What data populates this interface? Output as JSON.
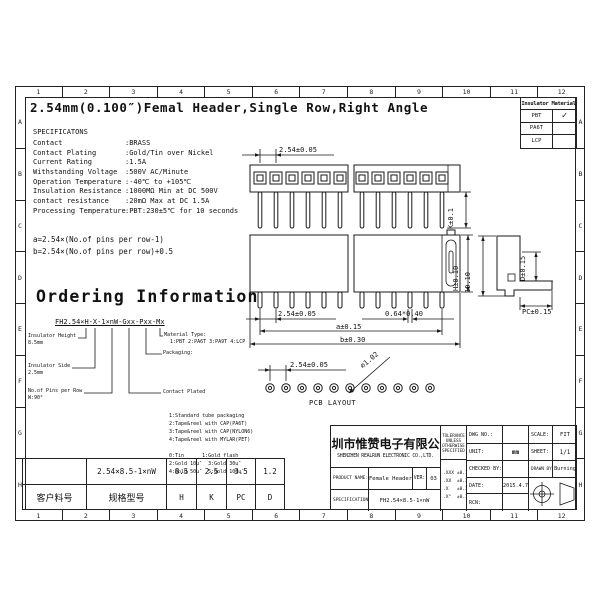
{
  "page": {
    "title": "2.54mm(0.100″)Femal Header,Single Row,Right Angle"
  },
  "border": {
    "columns": [
      "1",
      "2",
      "3",
      "4",
      "5",
      "6",
      "7",
      "8",
      "9",
      "10",
      "11",
      "12"
    ],
    "rows": [
      "A",
      "B",
      "C",
      "D",
      "E",
      "F",
      "G",
      "H"
    ]
  },
  "insulator_table": {
    "header": "Insulator Material",
    "rows": [
      {
        "name": "PBT",
        "check": "✓"
      },
      {
        "name": "PA6T",
        "check": ""
      },
      {
        "name": "LCP",
        "check": ""
      }
    ]
  },
  "specs": {
    "heading": "SPECIFICATONS",
    "rows": [
      {
        "label": "Contact",
        "value": ":BRASS"
      },
      {
        "label": "Contact Plating",
        "value": ":Gold/Tin over Nickel"
      },
      {
        "label": "Current Rating",
        "value": ":1.5A"
      },
      {
        "label": "Withstanding Voltage",
        "value": ":500V AC/Minute"
      },
      {
        "label": "Operation Temperature",
        "value": ":-40℃ to +105℃"
      },
      {
        "label": "Insulation Resistance",
        "value": ":1000MΩ Min at DC 500V"
      },
      {
        "label": "contact resistance",
        "value": ":20mΩ Max at DC 1.5A"
      },
      {
        "label": "Processing Temperature",
        "value": ":PBT:230±5℃ for 10 seconds"
      }
    ]
  },
  "notes": {
    "a": "a=2.54×(No.of pins per row-1)",
    "b": "b=2.54×(No.of pins per row)+0.5"
  },
  "ordering": {
    "heading": "Ordering Information",
    "code": "FH2.54×H-X-1×nW-Gxx-Pxx-Mx",
    "height": {
      "label": "Insulator Height",
      "value": "8.5mm"
    },
    "side": {
      "label": "Insulator Side",
      "value": "2.5mm"
    },
    "pins": {
      "label": "No.of Pins per Row",
      "value": "W:90°"
    },
    "material": {
      "label": "Material Type:",
      "options": "1:PBT 2:PA6T 3:PA9T 4:LCP"
    },
    "packaging": {
      "label": "Packaging:",
      "options": [
        "1:Standard tube packaging",
        "2:Tape&reel with CAP(PA6T)",
        "3:Tape&reel with CAP(NYLON6)",
        "4:Tape&reel with MYLAR(PET)"
      ]
    },
    "plating": {
      "label": "Contact Plated",
      "options": [
        "0:Tin      1:Gold flash",
        "2:Gold 10u″  3:Gold 30u″",
        "4:Gold 50u″  5:Gold 100u″"
      ]
    }
  },
  "dims": {
    "top_pitch": "2.54±0.05",
    "top_k": "K±0.1",
    "front_pitch": "2.54±0.05",
    "front_pin": "0.64*0.40",
    "front_a": "a±0.15",
    "front_b": "b±0.30",
    "front_h": "H±0.10",
    "side_height": "10.10",
    "side_d": "D±0.15",
    "side_pc": "PC±0.15",
    "pcb_pitch": "2.54±0.05",
    "pcb_hole": "⌀1.02",
    "pcb_label": "PCB LAYOUT"
  },
  "diagram": {
    "positions": 12,
    "pcb_pads": 11
  },
  "spec_table": {
    "rows": [
      [
        "",
        "2.54×8.5-1×nW",
        "8.5",
        "2.5",
        "3.5",
        "1.2"
      ],
      [
        "客户料号",
        "规格型号",
        "H",
        "K",
        "PC",
        "D"
      ]
    ]
  },
  "title_block": {
    "company_cn": "深圳市惟赞电子有限公司",
    "company_en": "SHENZHEN REALRUN ELECTRONIC CO.,LTD.",
    "product_label": "PRODUCT NAME:",
    "product": "Female Header",
    "ver_label": "VER:",
    "ver": "03",
    "spec_label": "SPECIFICATION:",
    "spec": "FH2.54×8.5-1×nW",
    "tol_head": [
      "TOLERANCE",
      "UNLESS",
      "OTHERWISE",
      "SPECIFIED"
    ],
    "tolerances": [
      ".XXX ±0.10",
      ".XX  ±0.20",
      ".X   ±0.30",
      ".X°  ±0.3°"
    ],
    "dwg_label": "DWG NO.:",
    "dwg": "",
    "scale_label": "SCALE:",
    "scale": "FIT",
    "unit_label": "UNIT:",
    "unit": "mm",
    "sheet_label": "SHEET:",
    "sheet": "1/1",
    "checked_label": "CHECKED BY:",
    "checked": "",
    "drawn_label": "DRAWN BY:",
    "drawn": "Burning",
    "date_label": "DATE:",
    "date": "2015.4.7",
    "rcn_label": "RCN:",
    "rcn": ""
  }
}
